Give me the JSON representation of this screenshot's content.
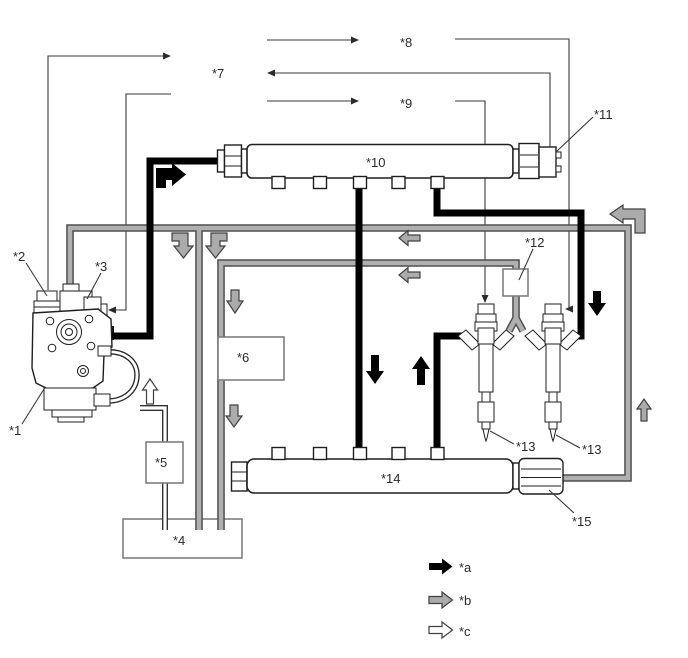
{
  "figure": {
    "callouts": {
      "c1": "*1",
      "c2": "*2",
      "c3": "*3",
      "c4": "*4",
      "c5": "*5",
      "c6": "*6",
      "c7": "*7",
      "c8": "*8",
      "c9": "*9",
      "c10": "*10",
      "c11": "*11",
      "c12": "*12",
      "c13_left": "*13",
      "c13_right": "*13",
      "c14": "*14",
      "c15": "*15"
    },
    "legend": {
      "a_label": "*a",
      "b_label": "*b",
      "c_label": "*c",
      "a_symbol": "black-filled-arrow",
      "b_symbol": "gray-filled-arrow",
      "c_symbol": "white-outline-arrow"
    },
    "colors": {
      "black_line": "#000000",
      "gray_pipe": "#b0b0b0",
      "gray_pipe_edge": "#4f4f4f",
      "gray_arrow": "#ababab",
      "box_border": "#7e7e7e",
      "part_outline": "#1f1f1f",
      "text": "#2b2b2b",
      "background": "#ffffff"
    }
  }
}
